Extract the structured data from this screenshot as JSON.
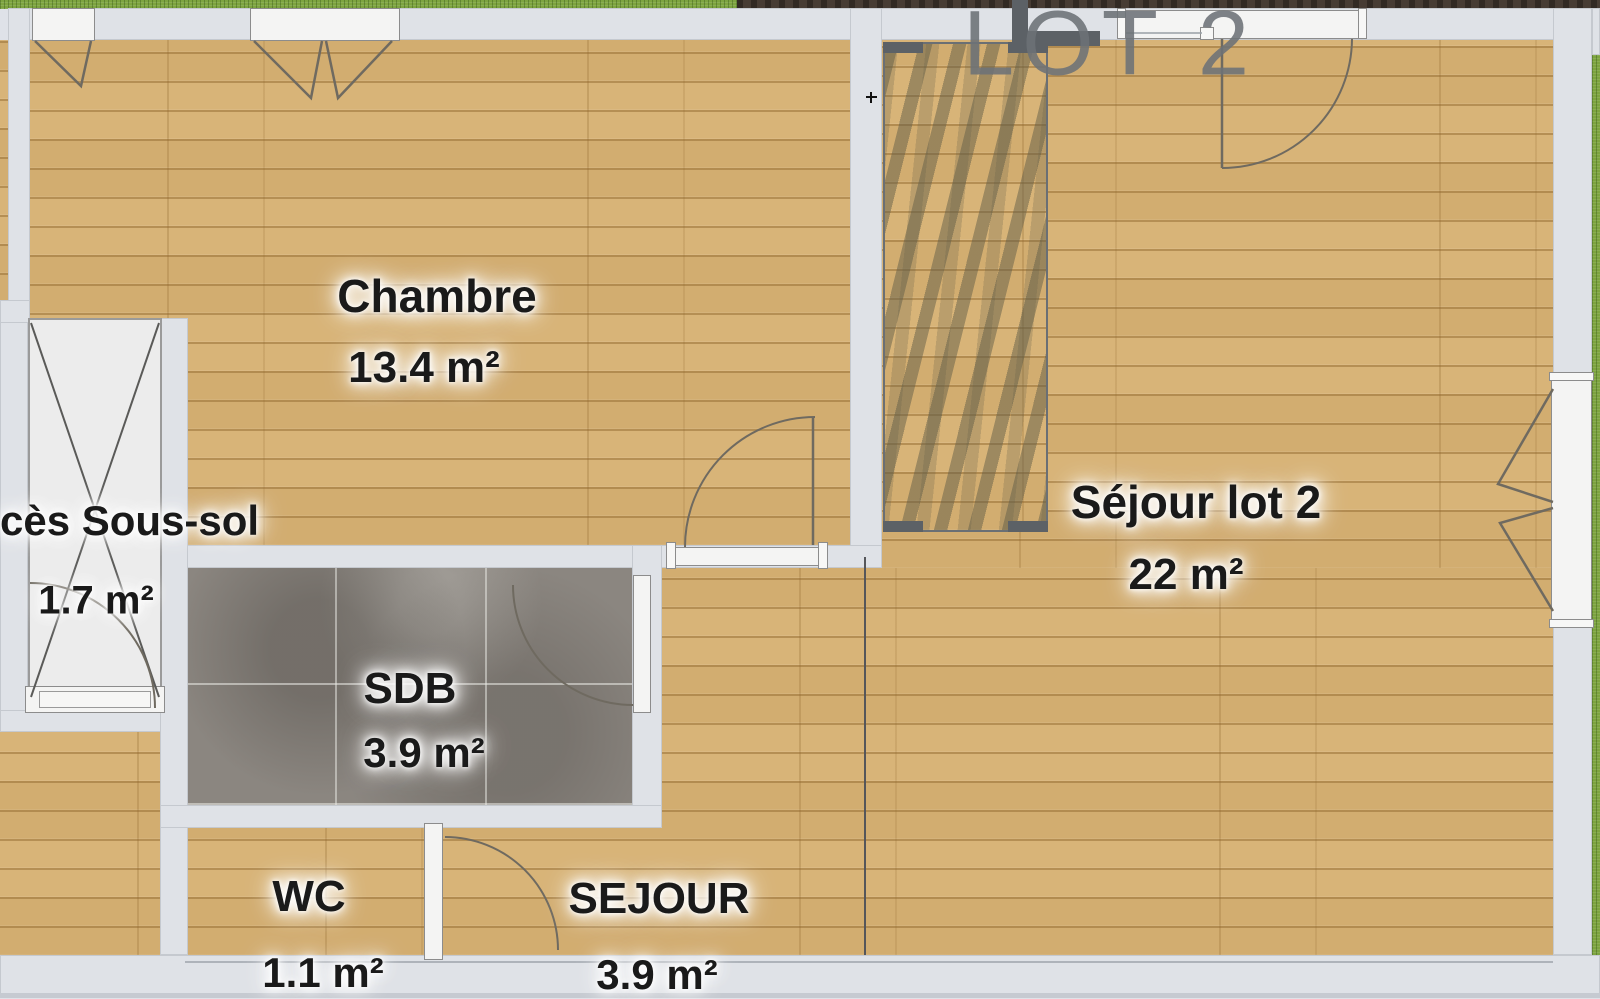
{
  "plan": {
    "lot_title": "LOT 2",
    "rooms": [
      {
        "name": "Chambre",
        "area": "13.4 m²"
      },
      {
        "name": "Séjour lot 2",
        "area": "22 m²"
      },
      {
        "name": "cès Sous-sol",
        "area": "1.7 m²"
      },
      {
        "name": "SDB",
        "area": "3.9 m²"
      },
      {
        "name": "WC",
        "area": "1.1 m²"
      },
      {
        "name": "SEJOUR",
        "area": "3.9 m²"
      }
    ],
    "colors": {
      "wall": "#dfe2e7",
      "wood": "#d8b478",
      "wood_line": "#b28a4e",
      "tile": "#8b8680",
      "grass": "#7da440",
      "soil": "#473c34",
      "label_text": "#1a1a1a",
      "lot_text": "#6d7277",
      "plan_line": "#6f6a60"
    }
  }
}
